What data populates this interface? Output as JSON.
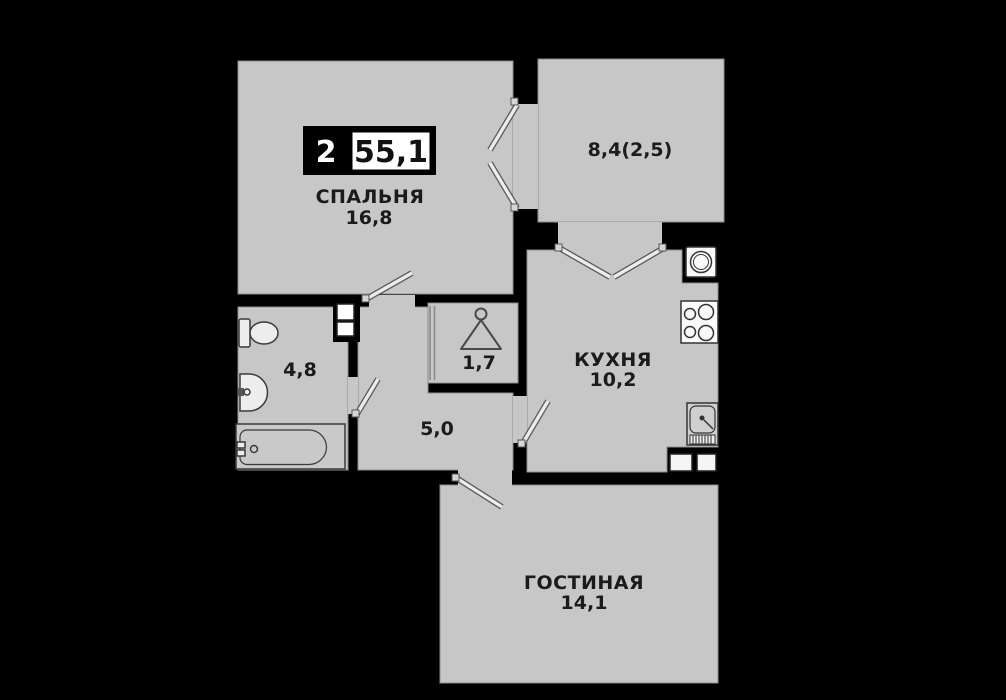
{
  "plan": {
    "badge": {
      "room_count": "2",
      "total_area": "55,1"
    },
    "rooms": {
      "bedroom": {
        "name": "СПАЛЬНЯ",
        "area": "16,8"
      },
      "balcony": {
        "area": "8,4(2,5)"
      },
      "kitchen": {
        "name": "КУХНЯ",
        "area": "10,2"
      },
      "bathroom": {
        "area": "4,8"
      },
      "wardrobe": {
        "area": "1,7"
      },
      "hallway": {
        "area": "5,0"
      },
      "living": {
        "name": "ГОСТИНАЯ",
        "area": "14,1"
      }
    },
    "colors": {
      "background": "#000000",
      "floor": "#c7c7c7",
      "walls": "#000000",
      "labels": "#1b1b1b"
    },
    "icons": [
      "hanger-icon",
      "toilet-icon",
      "bathroom-sink-icon",
      "bathtub-icon",
      "washing-machine-icon",
      "stove-icon",
      "kitchen-sink-icon",
      "cabinet-icon"
    ]
  }
}
